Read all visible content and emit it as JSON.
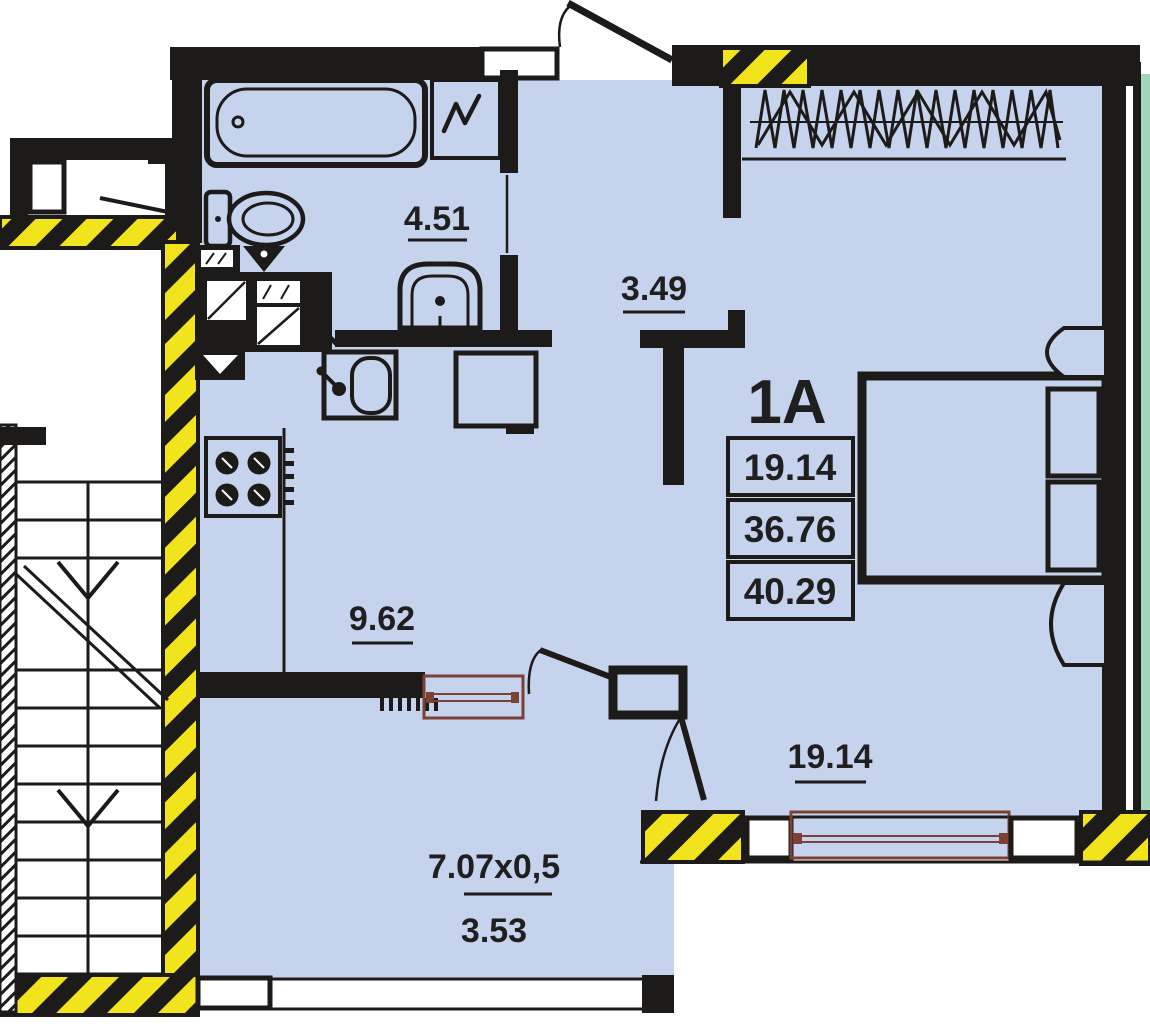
{
  "plan": {
    "unit_label": "1A",
    "area_table": {
      "rows": [
        "19.14",
        "36.76",
        "40.29"
      ]
    },
    "rooms": {
      "bathroom": {
        "area": "4.51"
      },
      "hallway": {
        "area": "3.49"
      },
      "kitchen": {
        "area": "9.62"
      },
      "living_room": {
        "area": "19.14"
      },
      "balcony": {
        "dimensions": "7.07x0,5",
        "area": "3.53"
      }
    },
    "fixtures": [
      "bathtub",
      "washing-machine",
      "toilet",
      "washbasin",
      "ventilation-shaft",
      "kitchen-sink",
      "stove",
      "refrigerator",
      "bed",
      "pillows",
      "bedside-tables",
      "wardrobe",
      "window",
      "balcony-door",
      "entrance-door",
      "staircase",
      "elevator"
    ],
    "colors": {
      "room_fill": "#c6d3ec",
      "wall": "#1d1b19",
      "hazard_yellow": "#f2e41c",
      "window_frame": "#7b4136",
      "adjacent_unit_fill": "#a3d6bd",
      "background": "#ffffff"
    }
  }
}
